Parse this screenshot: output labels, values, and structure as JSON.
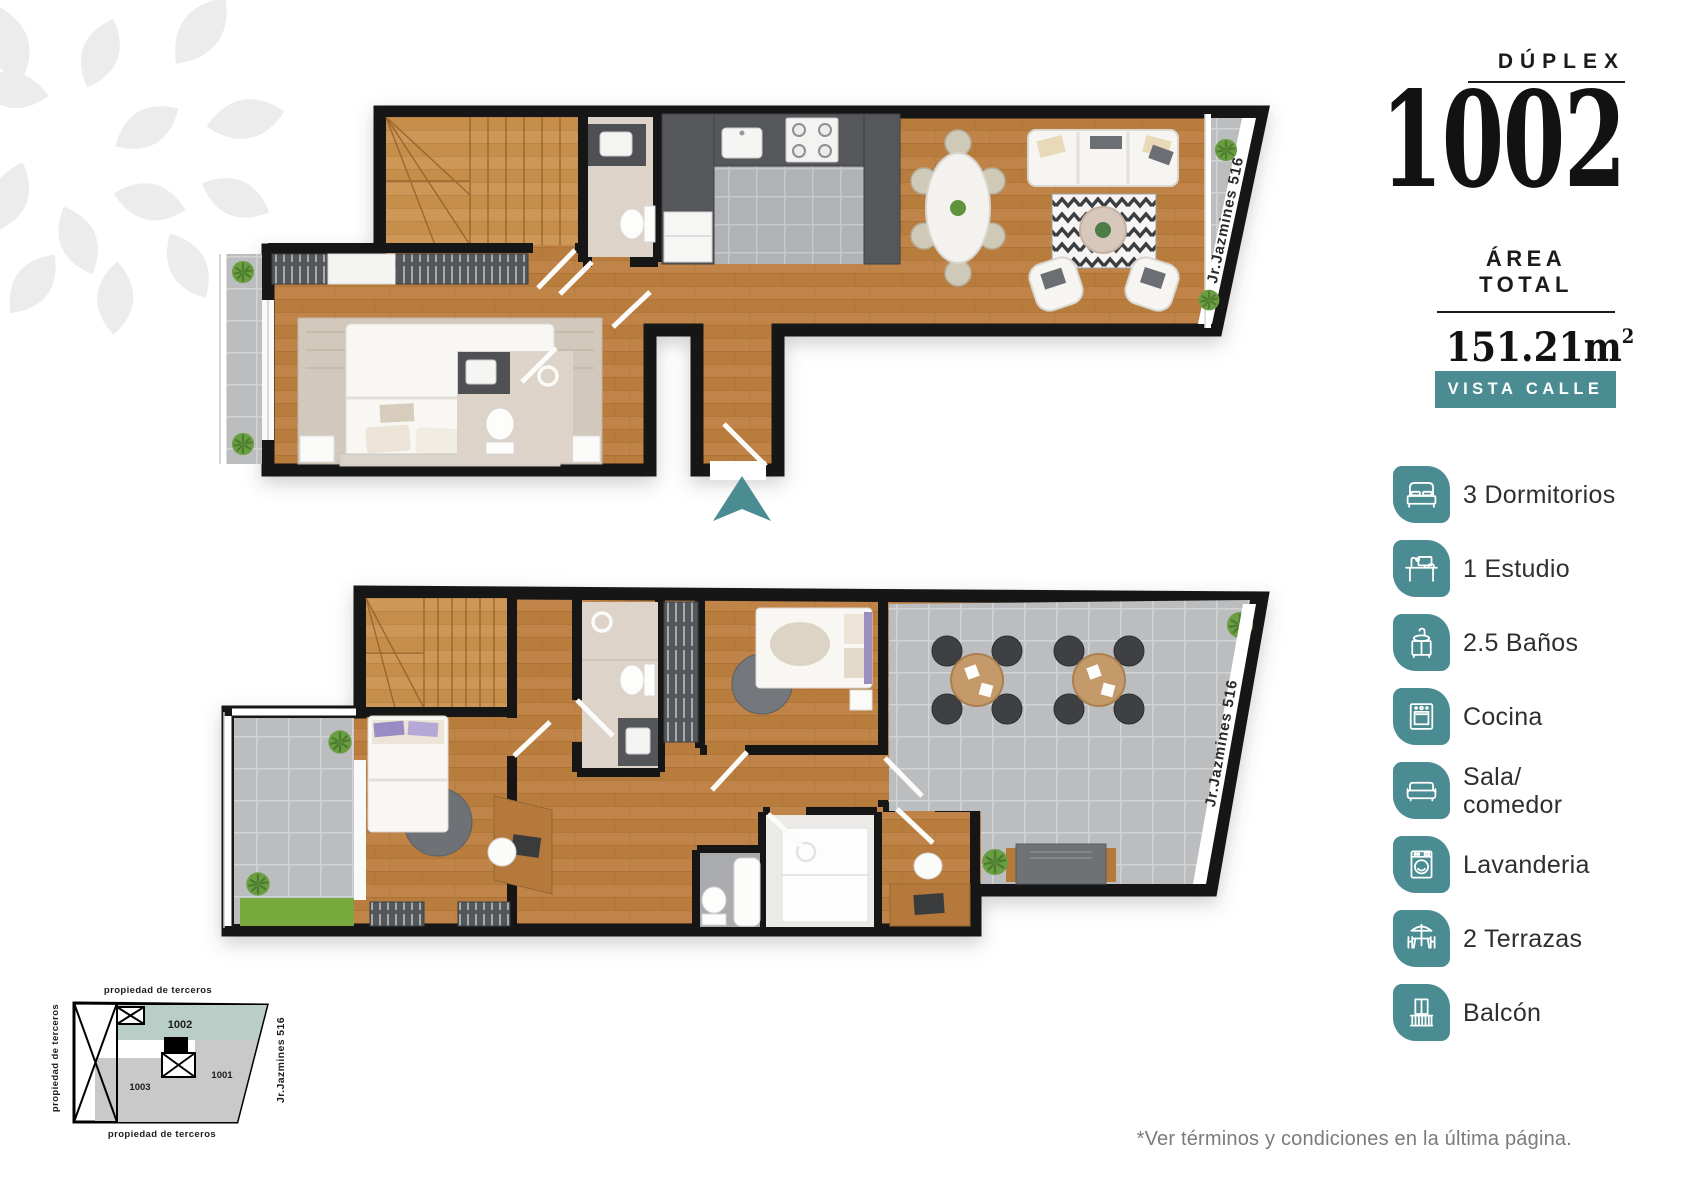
{
  "header": {
    "type_label": "DÚPLEX",
    "unit_number": "1002",
    "area_label": "ÁREA TOTAL",
    "area_value": "151.21m",
    "area_exponent": "2",
    "view_badge": "VISTA CALLE"
  },
  "features": [
    {
      "icon": "bed-icon",
      "label": "3 Dormitorios"
    },
    {
      "icon": "desk-icon",
      "label": "1 Estudio"
    },
    {
      "icon": "bath-sink-icon",
      "label": "2.5 Baños"
    },
    {
      "icon": "oven-icon",
      "label": "Cocina"
    },
    {
      "icon": "sofa-icon",
      "label": "Sala/\ncomedor"
    },
    {
      "icon": "washing-machine-icon",
      "label": "Lavanderia"
    },
    {
      "icon": "terrace-icon",
      "label": "2 Terrazas"
    },
    {
      "icon": "balcony-icon",
      "label": "Balcón"
    }
  ],
  "floor_plans": {
    "street_label": "Jr.Jazmines 516"
  },
  "site_plan": {
    "label_top": "propiedad de terceros",
    "label_left": "propiedad de terceros",
    "label_bottom": "propiedad de terceros",
    "street_label": "Jr.Jazmines 516",
    "unit_highlight": "1002",
    "unit_right": "1001",
    "unit_bottom": "1003"
  },
  "disclaimer": "*Ver términos y condiciones en la última página.",
  "colors": {
    "accent_teal": "#4A8C91",
    "site_plan_highlight": "#B9CEC7"
  }
}
